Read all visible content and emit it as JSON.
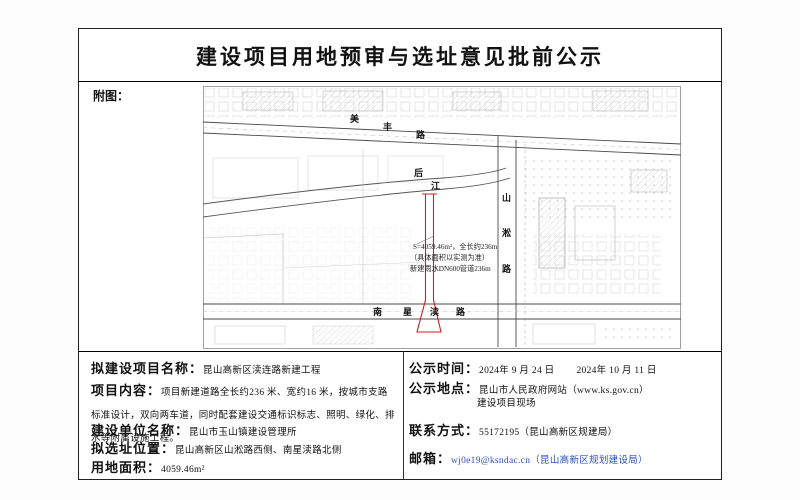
{
  "notice": {
    "title": "建设项目用地预审与选址意见批前公示",
    "map_caption": "附图："
  },
  "details": {
    "left": [
      {
        "label": "拟建设项目名称：",
        "value": "昆山高新区渎连路新建工程"
      },
      {
        "label": "项目内容：",
        "value": "项目新建道路全长约236 米、宽约16 米，按城市支路标准设计，双向两车道，同时配套建设交通标识标志、照明、绿化、排水等附属设施工程。"
      },
      {
        "label": "建设单位名称：",
        "value": "昆山市玉山镇建设管理所"
      },
      {
        "label": "拟选址位置：",
        "value": "昆山高新区山淞路西侧、南星渎路北侧"
      },
      {
        "label": "用地面积：",
        "value": "4059.46m²"
      }
    ],
    "right": {
      "publicity_time": {
        "label": "公示时间：",
        "start": "2024年 9 月 24 日",
        "end": "2024年 10 月 11 日"
      },
      "publicity_place": {
        "label": "公示地点：",
        "line1": "昆山市人民政府网站（www.ks.gov.cn）",
        "line2": "建设项目现场"
      },
      "contact": {
        "label": "联系方式：",
        "value": "55172195（昆山高新区规建局）"
      },
      "email": {
        "label": "邮箱：",
        "value": "wj0e19@ksndac.cn（昆山高新区规划建设局）",
        "color": "#2b50bd"
      }
    }
  },
  "map": {
    "road_top": [
      "美",
      "丰",
      "路"
    ],
    "river": [
      "后",
      "江"
    ],
    "road_right": [
      "山",
      "淞",
      "路"
    ],
    "road_bottom": [
      "南",
      "星",
      "渎",
      "路"
    ],
    "annotation": [
      "S=4059.46m²，全长约236m",
      "（具体面积以实测为准）",
      "新建雨水DN600管道236m"
    ],
    "highlight_color": "#cc2020"
  }
}
